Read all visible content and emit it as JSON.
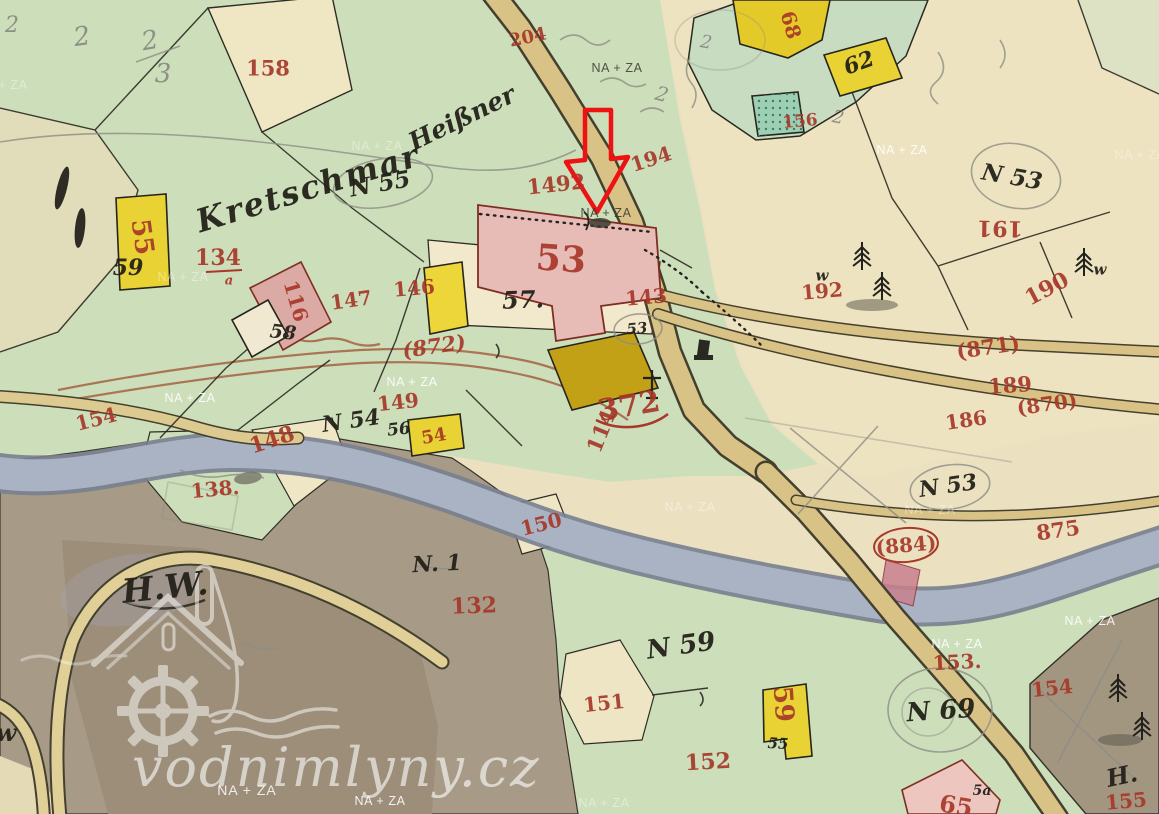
{
  "watermark": {
    "site": "vodnimlyny.cz",
    "credit": "NA + ZA"
  },
  "arrow": {
    "color": "#ee1212",
    "points_at_building": "53"
  },
  "map": {
    "colors": {
      "meadow_green": "#cddeba",
      "field_cream": "#ede3c0",
      "road_tan": "#d9c285",
      "river_gray": "#aab3c3",
      "waste_gray": "#a69a86",
      "building_yellow": "#e9d233",
      "building_dark_yellow": "#c3a117",
      "building_pink": "#e7bcb6",
      "ink_red": "#a7382a",
      "ink_black": "#23211a",
      "pencil_gray": "#8e8e85",
      "arrow_red": "#ee1212"
    },
    "na_za_text": "NA + ZA",
    "red_labels": [
      {
        "t": "158",
        "x": 268,
        "y": 68,
        "r": 0,
        "s": 21
      },
      {
        "t": "134",
        "x": 218,
        "y": 258,
        "r": 0,
        "s": 22
      },
      {
        "t": "a",
        "x": 229,
        "y": 281,
        "r": 0,
        "s": 13,
        "i": 1
      },
      {
        "t": "116",
        "x": 296,
        "y": 301,
        "r": 74,
        "s": 20
      },
      {
        "t": "55",
        "x": 142,
        "y": 237,
        "r": 82,
        "s": 26
      },
      {
        "t": "147",
        "x": 351,
        "y": 300,
        "r": -8,
        "s": 20
      },
      {
        "t": "146",
        "x": 414,
        "y": 288,
        "r": -5,
        "s": 20
      },
      {
        "t": "53",
        "x": 561,
        "y": 259,
        "r": 4,
        "s": 36
      },
      {
        "t": "1492",
        "x": 556,
        "y": 184,
        "r": -6,
        "s": 21
      },
      {
        "t": "194",
        "x": 651,
        "y": 159,
        "r": -18,
        "s": 20
      },
      {
        "t": "143",
        "x": 646,
        "y": 297,
        "r": -5,
        "s": 20
      },
      {
        "t": "(872)",
        "x": 434,
        "y": 346,
        "r": -8,
        "s": 21,
        "i": 1
      },
      {
        "t": "372",
        "x": 629,
        "y": 407,
        "r": -10,
        "s": 30
      },
      {
        "t": "114",
        "x": 601,
        "y": 431,
        "r": -68,
        "s": 21
      },
      {
        "t": "154",
        "x": 96,
        "y": 419,
        "r": -14,
        "s": 20
      },
      {
        "t": "149",
        "x": 398,
        "y": 402,
        "r": -6,
        "s": 20
      },
      {
        "t": "148",
        "x": 272,
        "y": 440,
        "r": -18,
        "s": 22
      },
      {
        "t": "138.",
        "x": 215,
        "y": 489,
        "r": -5,
        "s": 20
      },
      {
        "t": "150",
        "x": 541,
        "y": 524,
        "r": -14,
        "s": 20
      },
      {
        "t": "132",
        "x": 474,
        "y": 606,
        "r": -2,
        "s": 22
      },
      {
        "t": "151",
        "x": 604,
        "y": 703,
        "r": -6,
        "s": 20
      },
      {
        "t": "152",
        "x": 708,
        "y": 762,
        "r": -3,
        "s": 22
      },
      {
        "t": "153.",
        "x": 957,
        "y": 662,
        "r": -3,
        "s": 20
      },
      {
        "t": "154",
        "x": 1052,
        "y": 688,
        "r": -6,
        "s": 20
      },
      {
        "t": "155",
        "x": 1126,
        "y": 801,
        "r": -5,
        "s": 20
      },
      {
        "t": "59",
        "x": 783,
        "y": 704,
        "r": 86,
        "s": 26
      },
      {
        "t": "54",
        "x": 434,
        "y": 437,
        "r": -10,
        "s": 18
      },
      {
        "t": "65",
        "x": 956,
        "y": 806,
        "r": 10,
        "s": 24
      },
      {
        "t": "68",
        "x": 791,
        "y": 25,
        "r": 74,
        "s": 20
      },
      {
        "t": "156",
        "x": 800,
        "y": 122,
        "r": -5,
        "s": 17
      },
      {
        "t": "204",
        "x": 528,
        "y": 38,
        "r": -12,
        "s": 18
      },
      {
        "t": "189",
        "x": 1010,
        "y": 385,
        "r": -4,
        "s": 21
      },
      {
        "t": "190",
        "x": 1047,
        "y": 289,
        "r": -28,
        "s": 22
      },
      {
        "t": "191",
        "x": 1000,
        "y": 228,
        "r": 181,
        "s": 22
      },
      {
        "t": "192",
        "x": 822,
        "y": 291,
        "r": -5,
        "s": 20
      },
      {
        "t": "(871)",
        "x": 988,
        "y": 347,
        "r": -8,
        "s": 21
      },
      {
        "t": "186",
        "x": 966,
        "y": 420,
        "r": -8,
        "s": 20
      },
      {
        "t": "(870)",
        "x": 1047,
        "y": 404,
        "r": -8,
        "s": 20
      },
      {
        "t": "(884)",
        "x": 906,
        "y": 545,
        "r": -5,
        "s": 20
      },
      {
        "t": "875",
        "x": 1058,
        "y": 530,
        "r": -8,
        "s": 21
      }
    ],
    "black_labels": [
      {
        "t": "Kretschmar",
        "x": 308,
        "y": 188,
        "r": -17,
        "s": 32,
        "ls": 2
      },
      {
        "t": "Heißner",
        "x": 462,
        "y": 118,
        "r": -26,
        "s": 25
      },
      {
        "t": "N 55",
        "x": 380,
        "y": 184,
        "r": -10,
        "s": 23
      },
      {
        "t": "57.",
        "x": 523,
        "y": 300,
        "r": -2,
        "s": 24
      },
      {
        "t": "N 54",
        "x": 351,
        "y": 421,
        "r": -8,
        "s": 22
      },
      {
        "t": "56",
        "x": 399,
        "y": 430,
        "r": -6,
        "s": 17
      },
      {
        "t": "N 59",
        "x": 681,
        "y": 646,
        "r": -8,
        "s": 26
      },
      {
        "t": "N 69",
        "x": 941,
        "y": 711,
        "r": -4,
        "s": 26
      },
      {
        "t": "N 53",
        "x": 948,
        "y": 486,
        "r": -8,
        "s": 22
      },
      {
        "t": "N 53",
        "x": 1012,
        "y": 177,
        "r": 10,
        "s": 23
      },
      {
        "t": "H.W.",
        "x": 165,
        "y": 587,
        "r": -6,
        "s": 33
      },
      {
        "t": "N. 1",
        "x": 437,
        "y": 564,
        "r": -3,
        "s": 22
      },
      {
        "t": "H.",
        "x": 1122,
        "y": 776,
        "r": -12,
        "s": 24
      },
      {
        "t": "w",
        "x": 6,
        "y": 733,
        "r": 0,
        "s": 24
      },
      {
        "t": "59",
        "x": 128,
        "y": 268,
        "r": 0,
        "s": 22
      },
      {
        "t": "58",
        "x": 283,
        "y": 333,
        "r": 6,
        "s": 19
      },
      {
        "t": "62",
        "x": 859,
        "y": 63,
        "r": -20,
        "s": 22
      },
      {
        "t": "55",
        "x": 778,
        "y": 744,
        "r": 3,
        "s": 15
      },
      {
        "t": "5a",
        "x": 982,
        "y": 791,
        "r": 0,
        "s": 14
      },
      {
        "t": "53",
        "x": 637,
        "y": 329,
        "r": -5,
        "s": 15
      },
      {
        "t": "w",
        "x": 822,
        "y": 276,
        "r": 0,
        "s": 15
      },
      {
        "t": "w",
        "x": 1100,
        "y": 270,
        "r": 0,
        "s": 15
      }
    ],
    "pencil_labels": [
      {
        "t": "2",
        "x": 82,
        "y": 37,
        "r": -8,
        "s": 26
      },
      {
        "t": "2",
        "x": 150,
        "y": 41,
        "r": -10,
        "s": 26
      },
      {
        "t": "3",
        "x": 163,
        "y": 74,
        "r": 0,
        "s": 26
      },
      {
        "t": "2",
        "x": 12,
        "y": 26,
        "r": 0,
        "s": 22
      },
      {
        "t": "2",
        "x": 662,
        "y": 94,
        "r": 15,
        "s": 20
      },
      {
        "t": "2",
        "x": 706,
        "y": 43,
        "r": 10,
        "s": 18
      },
      {
        "t": "2",
        "x": 838,
        "y": 118,
        "r": 12,
        "s": 18
      }
    ],
    "na_za_marks": [
      {
        "x": 617,
        "y": 68,
        "v": "dark"
      },
      {
        "x": 377,
        "y": 146,
        "v": "faint"
      },
      {
        "x": 902,
        "y": 150
      },
      {
        "x": 1140,
        "y": 155,
        "v": "faint"
      },
      {
        "x": 606,
        "y": 213,
        "v": "dark"
      },
      {
        "x": 183,
        "y": 277,
        "v": "faint"
      },
      {
        "x": 412,
        "y": 382
      },
      {
        "x": 190,
        "y": 398
      },
      {
        "x": 690,
        "y": 507,
        "v": "faint"
      },
      {
        "x": 930,
        "y": 510,
        "v": "faint"
      },
      {
        "x": 1090,
        "y": 621
      },
      {
        "x": 957,
        "y": 644
      },
      {
        "x": 380,
        "y": 801
      },
      {
        "x": 604,
        "y": 803,
        "v": "faint"
      },
      {
        "x": 2,
        "y": 85,
        "v": "faint"
      }
    ]
  }
}
